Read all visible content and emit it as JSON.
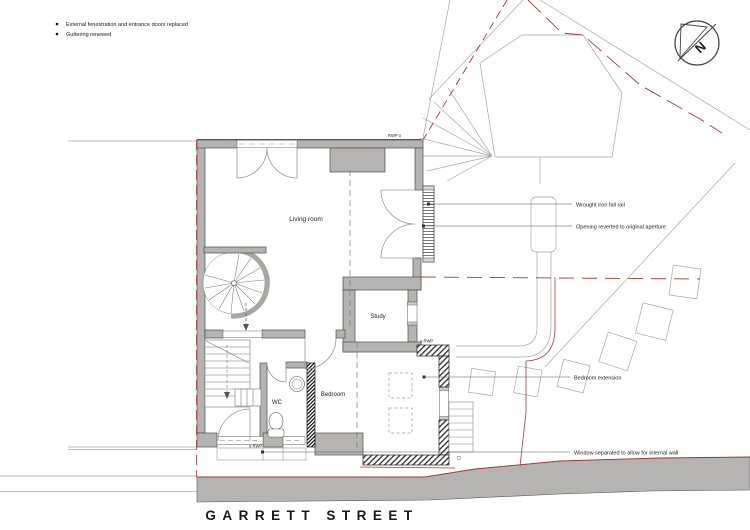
{
  "title": {
    "street_name": "GARRETT STREET"
  },
  "notes": {
    "items": [
      {
        "label": "External fenestration and entrance doors replaced"
      },
      {
        "label": "Guttering renewed"
      }
    ]
  },
  "compass": {
    "north_label": "N"
  },
  "rooms": {
    "living_room": "Living room",
    "study": "Study",
    "wc": "WC",
    "bedroom": "Bedroom"
  },
  "annotations": {
    "fall_rail": "Wrought iron fall rail",
    "opening_reverted": "Opening reverted to original aperture",
    "bedroom_extension": "Bedroom extension",
    "window_separated": "Window separated to allow for internal wall",
    "rwp_top": "RWP o",
    "rwp_side": "o RWP",
    "rwp_front": "o RWP"
  },
  "colors": {
    "wall_gray": "#b6b3b3",
    "wall_outline": "#4d4d4d",
    "boundary_red": "#a63a32",
    "drawing_gray": "#9a9a9a",
    "text_black": "#1a1a1a"
  }
}
